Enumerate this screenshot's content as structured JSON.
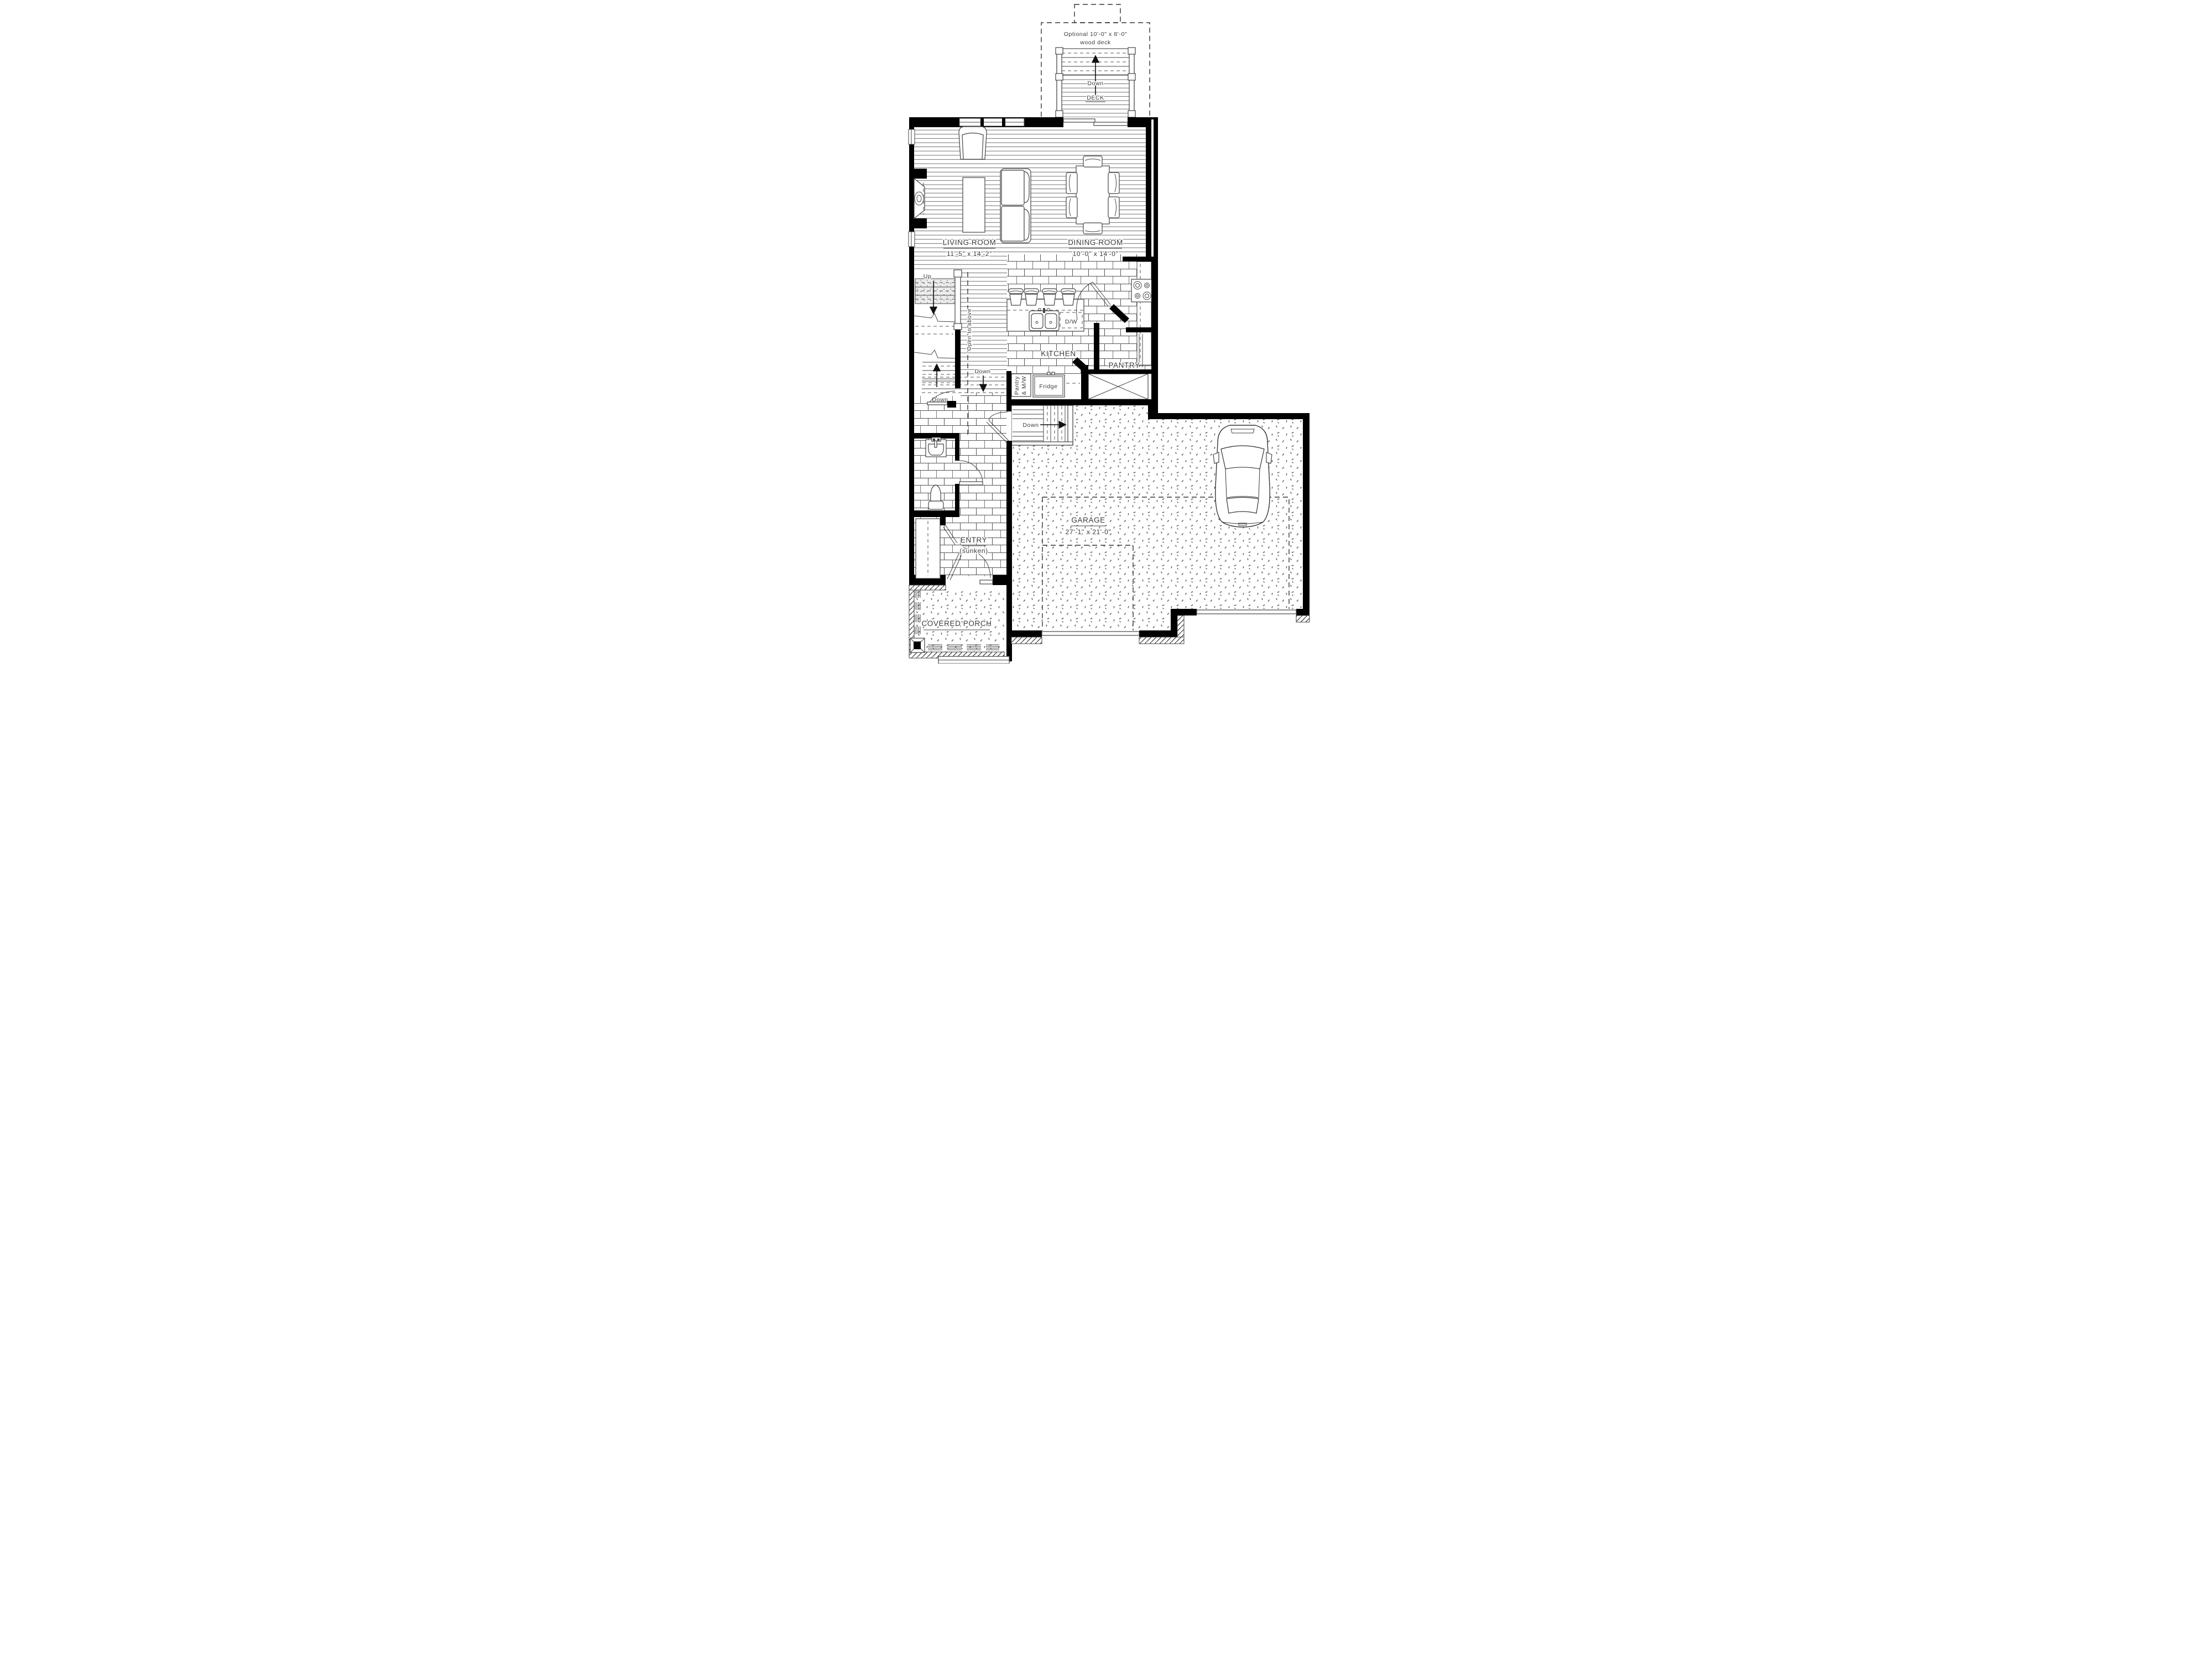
{
  "colors": {
    "wall": "#000000",
    "line": "#444444",
    "paper": "#ffffff",
    "stair_tread_fill": "#e9e9e9"
  },
  "labels": {
    "optional_deck_line1": "Optional 10'-0\" x 8'-0\"",
    "optional_deck_line2": "wood deck",
    "deck_down": "Down",
    "deck": "DECK",
    "living_room": "LIVING ROOM",
    "living_room_dim": "11'-5\" x 14'-2\"",
    "dining_room": "DINING ROOM",
    "dining_room_dim": "10'-0\" x 14'-0\"",
    "kitchen": "KITCHEN",
    "dw": "D/W",
    "pantry": "PANTRY",
    "pantry_mw_line1": "Pantry",
    "pantry_mw_line2": "& M/W",
    "fridge": "Fridge",
    "up": "Up",
    "open_to_above": "Open to above",
    "hall_down": "Down",
    "basement_down": "Down",
    "garage_stair_down": "Down",
    "garage": "GARAGE",
    "garage_dim": "27'-1\" x 21'-0\"",
    "entry": "ENTRY",
    "entry_sub": "(sunken)",
    "covered_porch": "COVERED PORCH"
  }
}
